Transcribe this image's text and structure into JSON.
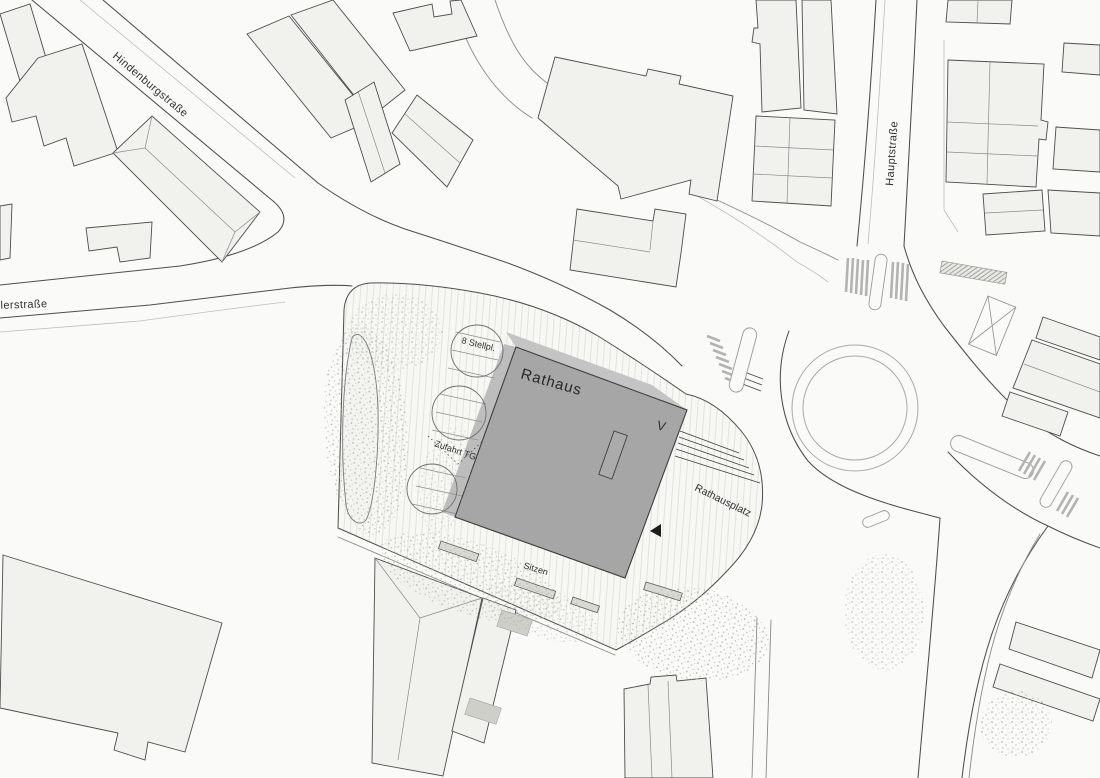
{
  "labels": {
    "street_hindenburg": "Hindenburgstraße",
    "street_haupt": "Hauptstraße",
    "street_schiller_partial": "illerstraße",
    "building_main": "Rathaus",
    "plaza": "Rathausplatz",
    "parking_count": "8 Stellpl.",
    "garage_access": "Zufahrt TG",
    "seating": "Sitzen",
    "entrance_marker": "V"
  },
  "colors": {
    "paper": "#fafaf8",
    "building_dark": "#a6a6a6",
    "building_parapet": "#c4c4c4",
    "building_light": "#f1f1ed",
    "line_dark": "#4d4d4d",
    "line_mid": "#8a8a8a",
    "line_light": "#bdbdbd",
    "hatch": "#e3e3de",
    "tree_stipple": "#a9b3a3",
    "bench_fill": "#d9d9d3",
    "marker_black": "#1c1c1c"
  }
}
